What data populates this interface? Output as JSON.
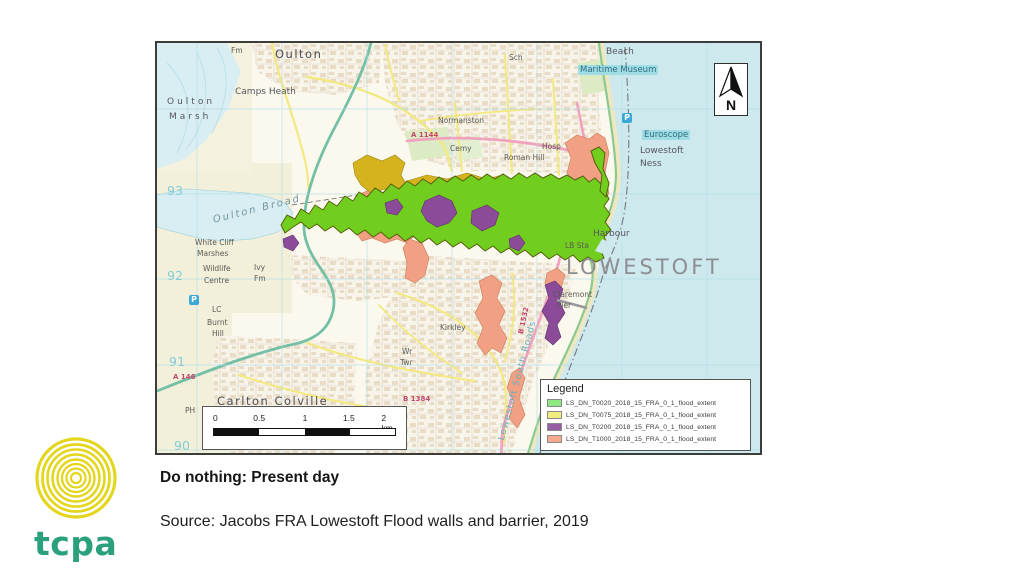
{
  "slide": {
    "caption": "Do nothing: Present day",
    "source": "Source: Jacobs FRA Lowestoft Flood walls and barrier, 2019"
  },
  "logo": {
    "text": "tcpa",
    "ring_color": "#E4D51D",
    "text_color": "#2AA17C"
  },
  "map": {
    "north_label": "N",
    "legend": {
      "title": "Legend",
      "items": [
        {
          "label": "LS_DN_T0020_2018_15_FRA_0_1_flood_extent",
          "color": "#90E883"
        },
        {
          "label": "LS_DN_T0075_2018_15_FRA_0_1_flood_extent",
          "color": "#F1EE7D"
        },
        {
          "label": "LS_DN_T0200_2018_15_FRA_0_1_flood_extent",
          "color": "#985EA4"
        },
        {
          "label": "LS_DN_T1000_2018_15_FRA_0_1_flood_extent",
          "color": "#F5A98D"
        }
      ]
    },
    "scalebar": {
      "labels": [
        "0",
        "0.5",
        "1",
        "1.5",
        "2 km"
      ]
    },
    "flood_colors": {
      "t0020": "#72CE1E",
      "t0075": "#D4B31E",
      "t0200": "#8C4B99",
      "t1000": "#F2A083"
    },
    "place_labels": [
      {
        "text": "Oulton",
        "x": 118,
        "y": 4,
        "cls": "place-md"
      },
      {
        "text": "Fm",
        "x": 74,
        "y": 3,
        "cls": "place-xs"
      },
      {
        "text": "Sch",
        "x": 352,
        "y": 10,
        "cls": "place-xs"
      },
      {
        "text": "Camps Heath",
        "x": 78,
        "y": 44,
        "cls": "place-sm"
      },
      {
        "text": "Oulton",
        "x": 10,
        "y": 54,
        "cls": "place-sm sp"
      },
      {
        "text": "Marsh",
        "x": 12,
        "y": 69,
        "cls": "place-sm sp"
      },
      {
        "text": "Normanston",
        "x": 281,
        "y": 73,
        "cls": "place-xs"
      },
      {
        "text": "Cemy",
        "x": 293,
        "y": 101,
        "cls": "place-xs"
      },
      {
        "text": "Roman Hill",
        "x": 347,
        "y": 110,
        "cls": "place-xs"
      },
      {
        "text": "Hosp",
        "x": 385,
        "y": 99,
        "cls": "place-xs"
      },
      {
        "text": "Beach",
        "x": 449,
        "y": 4,
        "cls": "place-sm"
      },
      {
        "text": "Maritime Museum",
        "x": 421,
        "y": 22,
        "cls": "water-hl"
      },
      {
        "text": "Euroscope",
        "x": 485,
        "y": 87,
        "cls": "water-hl"
      },
      {
        "text": "Lowestoft",
        "x": 483,
        "y": 103,
        "cls": "place-sm"
      },
      {
        "text": "Ness",
        "x": 483,
        "y": 116,
        "cls": "place-sm"
      },
      {
        "text": "P",
        "x": 465,
        "y": 70,
        "cls": "p-icon"
      },
      {
        "text": "P",
        "x": 32,
        "y": 252,
        "cls": "p-icon"
      },
      {
        "text": "Harbour",
        "x": 436,
        "y": 186,
        "cls": "place-sm"
      },
      {
        "text": "LB Sta",
        "x": 408,
        "y": 198,
        "cls": "place-xs"
      },
      {
        "text": "LOWESTOFT",
        "x": 409,
        "y": 212,
        "cls": "city"
      },
      {
        "text": "Claremont",
        "x": 396,
        "y": 247,
        "cls": "place-xs"
      },
      {
        "text": "Pier",
        "x": 400,
        "y": 258,
        "cls": "place-xs"
      },
      {
        "text": "Kirkley",
        "x": 283,
        "y": 280,
        "cls": "place-xs"
      },
      {
        "text": "Wr",
        "x": 245,
        "y": 304,
        "cls": "place-xs"
      },
      {
        "text": "Twr",
        "x": 243,
        "y": 315,
        "cls": "place-xs"
      },
      {
        "text": "Lowestoft South Roads",
        "x": 340,
        "y": 396,
        "cls": "water-rot",
        "rot": -75
      },
      {
        "text": "B 1532",
        "x": 360,
        "y": 290,
        "cls": "road-red",
        "rot": -78
      },
      {
        "text": "Carlton Colville",
        "x": 60,
        "y": 351,
        "cls": "place-md"
      },
      {
        "text": "LC",
        "x": 55,
        "y": 262,
        "cls": "place-xs"
      },
      {
        "text": "Burnt",
        "x": 50,
        "y": 275,
        "cls": "place-xs"
      },
      {
        "text": "Hill",
        "x": 55,
        "y": 286,
        "cls": "place-xs"
      },
      {
        "text": "PH",
        "x": 28,
        "y": 363,
        "cls": "place-xs"
      },
      {
        "text": "White Cliff",
        "x": 38,
        "y": 195,
        "cls": "place-xs"
      },
      {
        "text": "Marshes",
        "x": 40,
        "y": 206,
        "cls": "place-xs"
      },
      {
        "text": "Wildlife",
        "x": 46,
        "y": 221,
        "cls": "place-xs"
      },
      {
        "text": "Centre",
        "x": 47,
        "y": 233,
        "cls": "place-xs"
      },
      {
        "text": "Ivy",
        "x": 97,
        "y": 220,
        "cls": "place-xs"
      },
      {
        "text": "Fm",
        "x": 97,
        "y": 231,
        "cls": "place-xs"
      },
      {
        "text": "Oulton Broad",
        "x": 55,
        "y": 172,
        "cls": "water-it",
        "rot": -14
      },
      {
        "text": "A 1144",
        "x": 254,
        "y": 88,
        "cls": "road-red"
      },
      {
        "text": "A 146",
        "x": 16,
        "y": 330,
        "cls": "road-red"
      },
      {
        "text": "B 1384",
        "x": 246,
        "y": 352,
        "cls": "road-red"
      },
      {
        "text": "93",
        "x": 10,
        "y": 140,
        "cls": "grid-num"
      },
      {
        "text": "92",
        "x": 10,
        "y": 225,
        "cls": "grid-num"
      },
      {
        "text": "91",
        "x": 12,
        "y": 311,
        "cls": "grid-num"
      },
      {
        "text": "90",
        "x": 17,
        "y": 395,
        "cls": "grid-num"
      }
    ]
  }
}
